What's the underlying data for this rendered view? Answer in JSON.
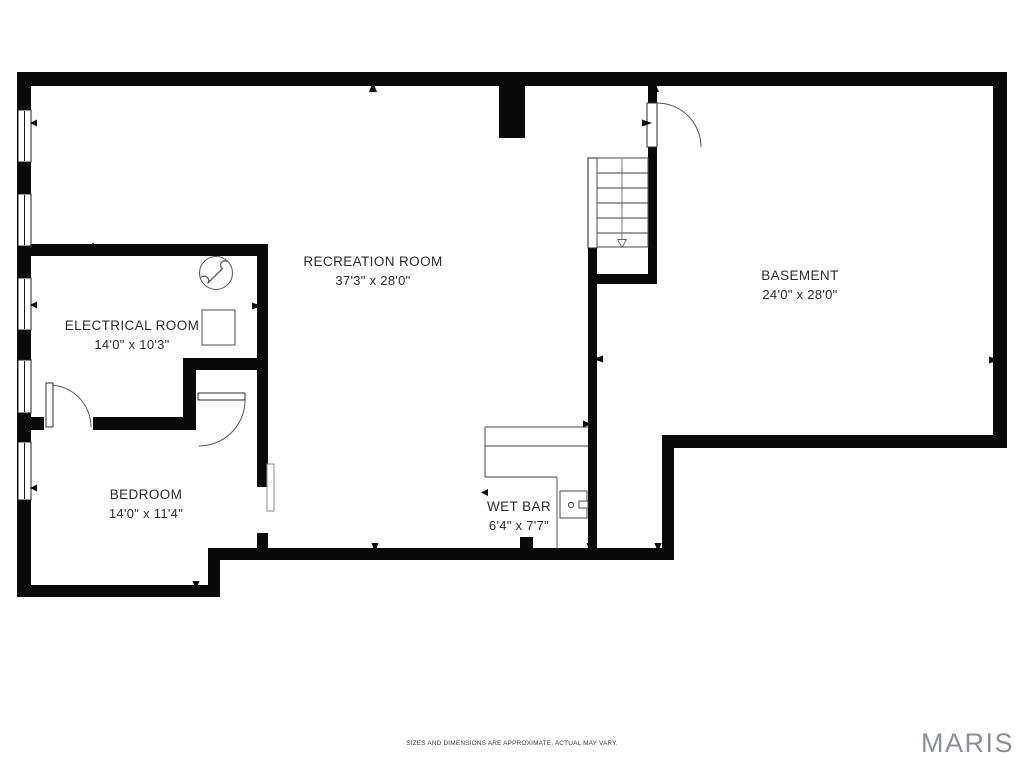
{
  "rooms": [
    {
      "name": "RECREATION ROOM",
      "dims": "37'3\" x 28'0\""
    },
    {
      "name": "BASEMENT",
      "dims": "24'0\" x 28'0\""
    },
    {
      "name": "ELECTRICAL ROOM",
      "dims": "14'0\" x 10'3\""
    },
    {
      "name": "BEDROOM",
      "dims": "14'0\" x 11'4\""
    },
    {
      "name": "WET BAR",
      "dims": "6'4\" x 7'7\""
    }
  ],
  "footer": {
    "disclaimer": "SIZES AND DIMENSIONS ARE APPROXIMATE, ACTUAL MAY VARY.",
    "brand": "MARIS"
  },
  "symbols": {
    "electrical_meter": "circle-lightning-bolt-icon",
    "electrical_panel": "panel-square-icon",
    "stairs": "stairs-down-arrow-icon",
    "wet_bar_sink": "sink-icon"
  },
  "colors": {
    "wall": "#0a0a0a",
    "text": "#2b2b2b",
    "brand_gray": "#8a8f97"
  }
}
